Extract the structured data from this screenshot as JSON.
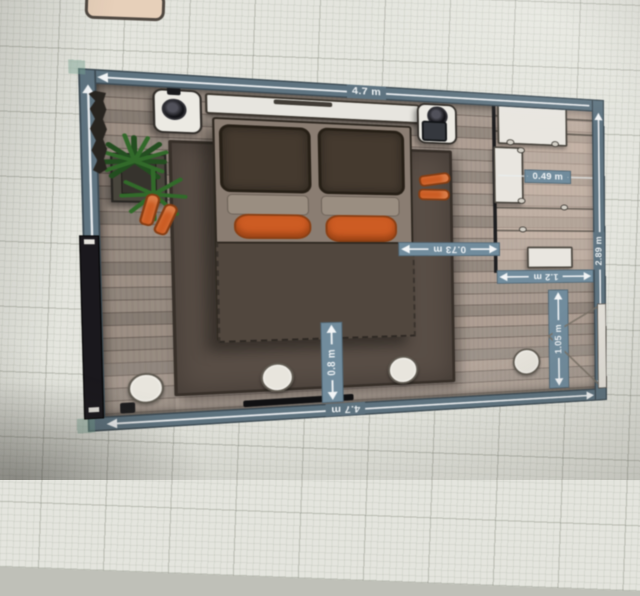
{
  "scene": {
    "description": "Photographed monitor showing a bedroom floor plan on a room-planner grid canvas"
  },
  "measurements": {
    "room_width_top": "4.7 m",
    "room_width_bottom": "4.7 m",
    "room_depth_right": "2.89 m",
    "wardrobe_clearance": "0.49 m",
    "passage_bed_to_wardrobe": "0.73 m",
    "wardrobe_width": "1.2 m",
    "bed_foot_clearance": "0.8 m",
    "door_clearance": "1.05 m"
  },
  "colors": {
    "wall_band": "#5d7482",
    "dimension_chip": "#6f8da0",
    "dimension_text": "#f2f6f8",
    "floor_wood": "#a2958a",
    "rug": "#584c43",
    "duvet": "#50453b",
    "pillow_dark": "#44382b",
    "pillow_accent_orange": "#d7591a",
    "furniture_white": "#efede6",
    "plant_green": "#2c6b24",
    "canvas_grid": "#e7e8e0"
  }
}
